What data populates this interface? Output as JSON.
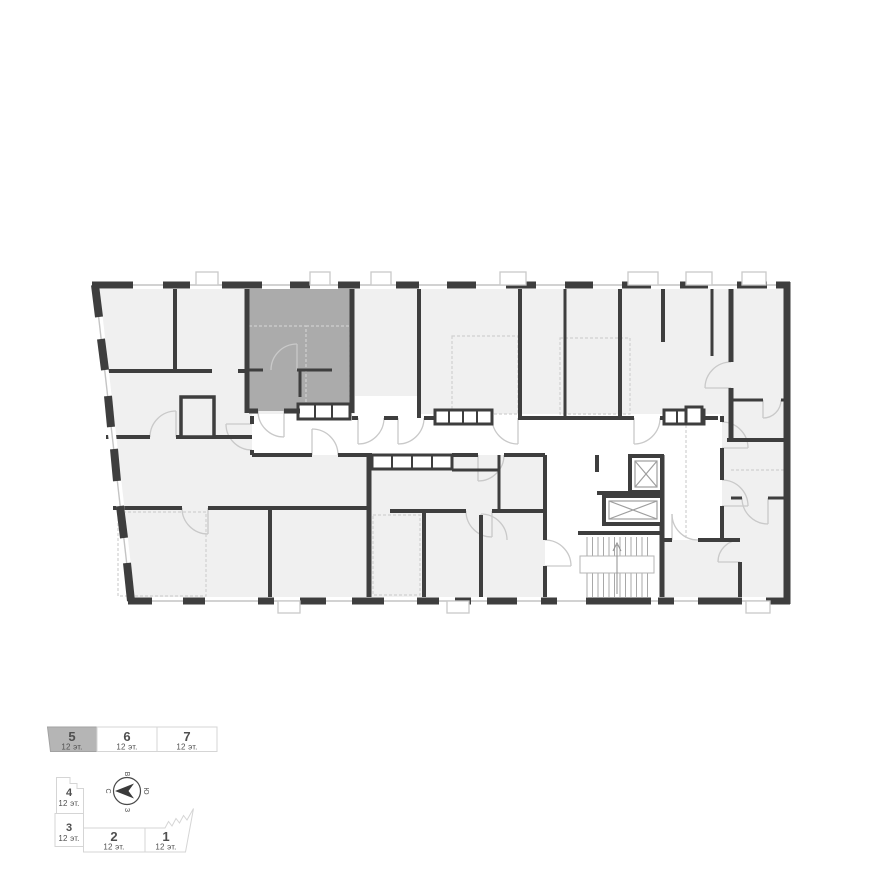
{
  "plan": {
    "colors": {
      "selected": "#ababab",
      "room": "#f0f0f0",
      "wall": "#3e3e3e",
      "corridor": "#ffffff",
      "legend_selected_fill": "#b5b5b5"
    }
  },
  "legend": {
    "sections": [
      {
        "number": "5",
        "floors": "12 эт.",
        "selected": true
      },
      {
        "number": "6",
        "floors": "12 эт.",
        "selected": false
      },
      {
        "number": "7",
        "floors": "12 эт.",
        "selected": false
      },
      {
        "number": "4",
        "floors": "12 эт.",
        "selected": false
      },
      {
        "number": "3",
        "floors": "12 эт.",
        "selected": false
      },
      {
        "number": "2",
        "floors": "12 эт.",
        "selected": false
      },
      {
        "number": "1",
        "floors": "12 эт.",
        "selected": false
      }
    ]
  },
  "compass": {
    "north": "С",
    "east": "В",
    "south": "Ю",
    "west": "З"
  }
}
